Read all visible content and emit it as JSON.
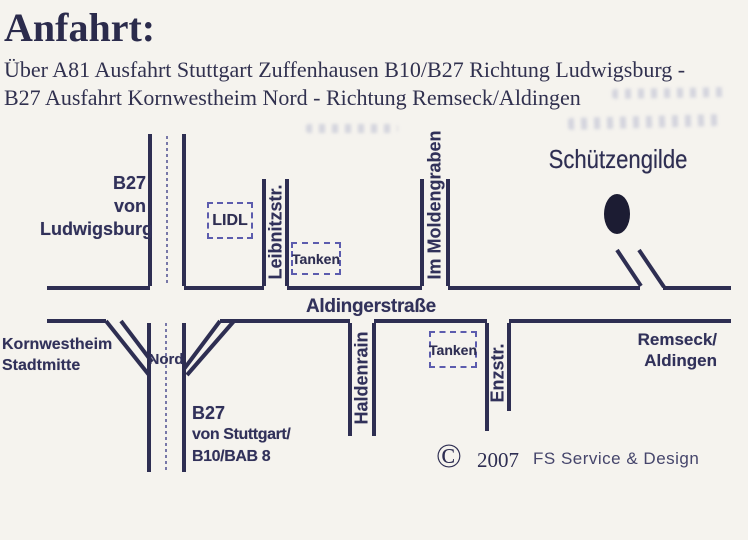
{
  "header": {
    "title": "Anfahrt:",
    "subtitle_line1": "Über A81 Ausfahrt Stuttgart Zuffenhausen B10/B27 Richtung Ludwigsburg -",
    "subtitle_line2": "B27 Ausfahrt Kornwestheim Nord - Richtung Remseck/Aldingen"
  },
  "map": {
    "destination": {
      "name": "Schützengilde"
    },
    "roads": {
      "b27_north": {
        "label_line1": "B27",
        "label_line2": "von",
        "label_line3": "Ludwigsburg"
      },
      "b27_south": {
        "label_line1": "B27",
        "label_line2": "von Stuttgart/",
        "label_line3": "B10/BAB 8"
      },
      "aldingerstrasse": {
        "label": "Aldingerstraße"
      },
      "leibnitzstrasse": {
        "label": "Leibnitzstr."
      },
      "im_moldengraben": {
        "label": "Im Moldengraben"
      },
      "haldenrain": {
        "label": "Haldenrain"
      },
      "enzstrasse": {
        "label": "Enzstr."
      },
      "nord_exit": {
        "label": "Nord"
      }
    },
    "pois": {
      "lidl": {
        "label": "LIDL"
      },
      "tanken_north": {
        "label": "Tanken"
      },
      "tanken_south": {
        "label": "Tanken"
      }
    },
    "directions_labels": {
      "kornwestheim": {
        "line1": "Kornwestheim",
        "line2": "Stadtmitte"
      },
      "remseck": {
        "line1": "Remseck/",
        "line2": "Aldingen"
      }
    }
  },
  "footer": {
    "copyright_symbol": "©",
    "year": "2007",
    "credit": "FS Service & Design"
  },
  "colors": {
    "ink": "#2e2e52",
    "background": "#f5f3ee",
    "box_border": "#5c5cae",
    "dashed_centerline": "#6a6aa0",
    "destination_dot": "#1c1c33"
  }
}
